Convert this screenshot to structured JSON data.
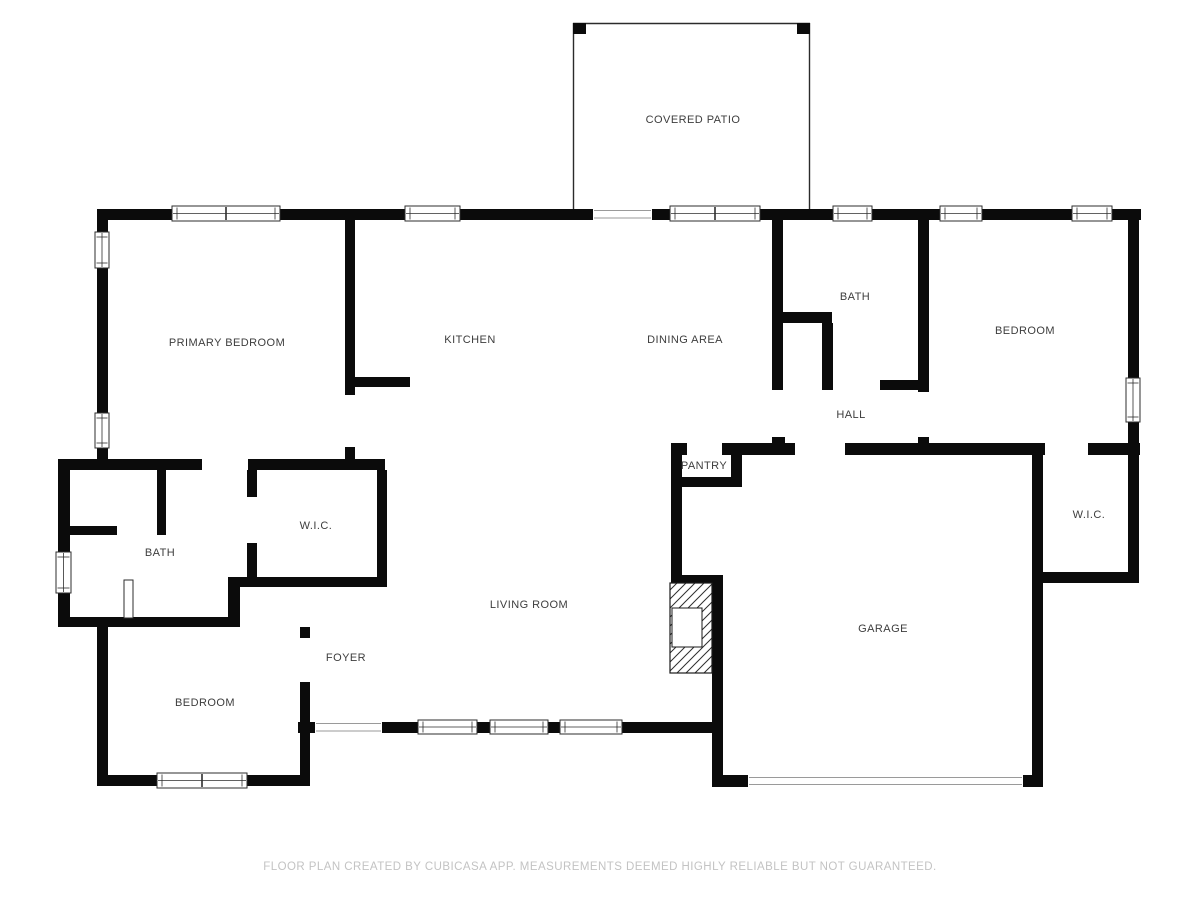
{
  "rooms": [
    {
      "id": "covered-patio",
      "label": "COVERED PATIO"
    },
    {
      "id": "primary-bedroom",
      "label": "PRIMARY BEDROOM"
    },
    {
      "id": "kitchen",
      "label": "KITCHEN"
    },
    {
      "id": "dining-area",
      "label": "DINING AREA"
    },
    {
      "id": "bath-upper",
      "label": "BATH"
    },
    {
      "id": "bedroom-right",
      "label": "BEDROOM"
    },
    {
      "id": "hall",
      "label": "HALL"
    },
    {
      "id": "pantry",
      "label": "PANTRY"
    },
    {
      "id": "wic-right",
      "label": "W.I.C."
    },
    {
      "id": "wic-left",
      "label": "W.I.C."
    },
    {
      "id": "bath-left",
      "label": "BATH"
    },
    {
      "id": "living-room",
      "label": "LIVING ROOM"
    },
    {
      "id": "garage",
      "label": "GARAGE"
    },
    {
      "id": "foyer",
      "label": "FOYER"
    },
    {
      "id": "bedroom-lower",
      "label": "BEDROOM"
    }
  ],
  "footer": {
    "disclaimer": "FLOOR PLAN CREATED BY CUBICASA APP. MEASUREMENTS DEEMED HIGHLY RELIABLE BUT NOT GUARANTEED."
  },
  "colors": {
    "wall": "#0b0b0b",
    "frame": "#2e2e2e",
    "thin": "#9a9a9a",
    "patio_line": "#2b2b2b",
    "label": "#3d3d3d",
    "footer": "#c3c3c3"
  },
  "plan": {
    "walls": [
      [
        97,
        209,
        75,
        11
      ],
      [
        280,
        209,
        125,
        11
      ],
      [
        460,
        209,
        133,
        11
      ],
      [
        652,
        209,
        18,
        11
      ],
      [
        760,
        209,
        73,
        11
      ],
      [
        872,
        209,
        68,
        11
      ],
      [
        982,
        209,
        90,
        11
      ],
      [
        1112,
        209,
        29,
        11
      ],
      [
        97,
        220,
        11,
        12
      ],
      [
        97,
        268,
        11,
        145
      ],
      [
        97,
        448,
        11,
        22
      ],
      [
        58,
        459,
        144,
        11
      ],
      [
        345,
        220,
        10,
        175
      ],
      [
        345,
        447,
        10,
        13
      ],
      [
        353,
        377,
        57,
        10
      ],
      [
        248,
        459,
        137,
        11
      ],
      [
        247,
        470,
        10,
        27
      ],
      [
        247,
        543,
        10,
        44
      ],
      [
        377,
        470,
        10,
        117
      ],
      [
        228,
        577,
        157,
        10
      ],
      [
        58,
        459,
        12,
        93
      ],
      [
        58,
        593,
        12,
        34
      ],
      [
        157,
        470,
        9,
        65
      ],
      [
        58,
        526,
        59,
        9
      ],
      [
        58,
        617,
        180,
        10
      ],
      [
        228,
        587,
        12,
        40
      ],
      [
        300,
        627,
        10,
        11
      ],
      [
        300,
        682,
        10,
        104
      ],
      [
        97,
        627,
        11,
        159
      ],
      [
        97,
        775,
        60,
        11
      ],
      [
        247,
        775,
        63,
        11
      ],
      [
        298,
        722,
        17,
        11
      ],
      [
        382,
        722,
        36,
        11
      ],
      [
        477,
        722,
        13,
        11
      ],
      [
        548,
        722,
        12,
        11
      ],
      [
        622,
        722,
        93,
        11
      ],
      [
        772,
        220,
        11,
        170
      ],
      [
        772,
        437,
        13,
        16
      ],
      [
        777,
        312,
        55,
        11
      ],
      [
        822,
        323,
        11,
        67
      ],
      [
        880,
        380,
        45,
        10
      ],
      [
        918,
        220,
        11,
        172
      ],
      [
        918,
        437,
        11,
        16
      ],
      [
        671,
        443,
        16,
        12
      ],
      [
        722,
        443,
        73,
        12
      ],
      [
        845,
        443,
        200,
        12
      ],
      [
        1088,
        443,
        52,
        12
      ],
      [
        671,
        455,
        11,
        120
      ],
      [
        731,
        455,
        11,
        32
      ],
      [
        671,
        477,
        71,
        10
      ],
      [
        671,
        575,
        52,
        10
      ],
      [
        712,
        585,
        11,
        202
      ],
      [
        1032,
        455,
        11,
        332
      ],
      [
        712,
        775,
        36,
        12
      ],
      [
        1023,
        775,
        20,
        12
      ],
      [
        1037,
        572,
        101,
        11
      ],
      [
        1128,
        220,
        11,
        158
      ],
      [
        1128,
        422,
        11,
        161
      ]
    ],
    "windows": [
      {
        "x": 172,
        "y": 206,
        "w": 108,
        "h": 15,
        "o": "h",
        "split": true
      },
      {
        "x": 405,
        "y": 206,
        "w": 55,
        "h": 15,
        "o": "h",
        "split": false
      },
      {
        "x": 670,
        "y": 206,
        "w": 90,
        "h": 15,
        "o": "h",
        "split": true
      },
      {
        "x": 833,
        "y": 206,
        "w": 39,
        "h": 15,
        "o": "h",
        "split": false
      },
      {
        "x": 940,
        "y": 206,
        "w": 42,
        "h": 15,
        "o": "h",
        "split": false
      },
      {
        "x": 1072,
        "y": 206,
        "w": 40,
        "h": 15,
        "o": "h",
        "split": false
      },
      {
        "x": 95,
        "y": 232,
        "w": 14,
        "h": 36,
        "o": "v",
        "split": false
      },
      {
        "x": 95,
        "y": 413,
        "w": 14,
        "h": 35,
        "o": "v",
        "split": false
      },
      {
        "x": 56,
        "y": 552,
        "w": 15,
        "h": 41,
        "o": "v",
        "split": false
      },
      {
        "x": 157,
        "y": 773,
        "w": 90,
        "h": 15,
        "o": "h",
        "split": true
      },
      {
        "x": 418,
        "y": 720,
        "w": 59,
        "h": 14,
        "o": "h",
        "split": false
      },
      {
        "x": 490,
        "y": 720,
        "w": 58,
        "h": 14,
        "o": "h",
        "split": false
      },
      {
        "x": 560,
        "y": 720,
        "w": 62,
        "h": 14,
        "o": "h",
        "split": false
      },
      {
        "x": 1126,
        "y": 378,
        "w": 14,
        "h": 44,
        "o": "v",
        "split": false
      }
    ],
    "door_lines": [
      [
        594,
        210.5,
        651,
        210.5
      ],
      [
        594,
        218,
        651,
        218
      ],
      [
        316,
        723.5,
        381,
        723.5
      ],
      [
        316,
        731,
        381,
        731
      ],
      [
        749,
        777.5,
        1022,
        777.5
      ],
      [
        749,
        784.5,
        1022,
        784.5
      ]
    ],
    "door_leaf": {
      "x": 124,
      "y": 580,
      "w": 9,
      "h": 38
    },
    "patio": {
      "lines": [
        [
          573.5,
          209,
          573.5,
          23
        ],
        [
          573,
          23.5,
          810,
          23.5
        ],
        [
          809.5,
          23,
          809.5,
          209
        ]
      ],
      "posts": [
        [
          573,
          23,
          13,
          11
        ],
        [
          797,
          23,
          13,
          11
        ]
      ]
    },
    "fireplace": {
      "x": 670,
      "y": 583,
      "w": 42,
      "h": 90,
      "box": {
        "x": 672,
        "y": 608,
        "w": 30,
        "h": 39
      }
    }
  }
}
